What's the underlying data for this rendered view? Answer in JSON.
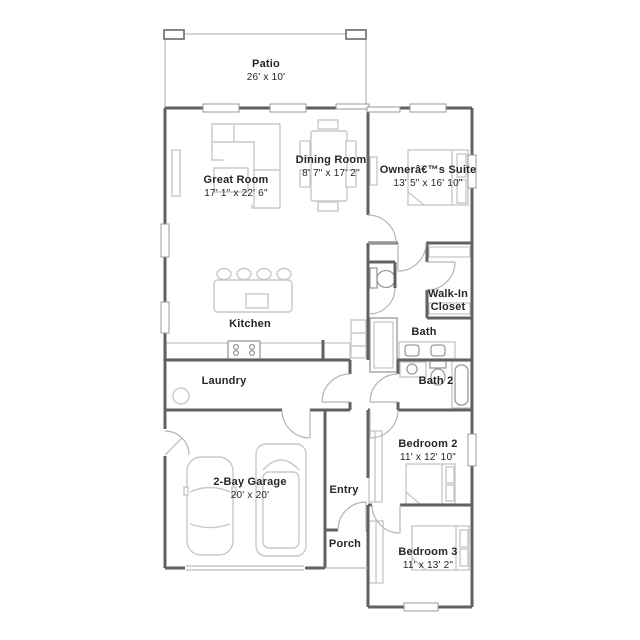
{
  "plan": {
    "colors": {
      "wall": "#616161",
      "light": "#c9c9c9",
      "door": "#b5b5b5",
      "text": "#262626"
    }
  },
  "rooms": [
    {
      "id": "patio",
      "name": "Patio",
      "dims": "26' x 10'",
      "cx": 266,
      "top": 58
    },
    {
      "id": "great-room",
      "name": "Great Room",
      "dims": "17' 1\" x 22' 6\"",
      "cx": 236,
      "top": 174
    },
    {
      "id": "dining-room",
      "name": "Dining Room",
      "dims": "8' 7\" x 17' 2\"",
      "cx": 331,
      "top": 154
    },
    {
      "id": "owners-suite",
      "name": "Ownerâ€™s Suite",
      "dims": "13' 5\" x 16' 10\"",
      "cx": 428,
      "top": 164
    },
    {
      "id": "kitchen",
      "name": "Kitchen",
      "dims": "",
      "cx": 250,
      "top": 318
    },
    {
      "id": "walk-in-closet",
      "name": "Walk-In Closet",
      "dims": "",
      "cx": 448,
      "top": 288
    },
    {
      "id": "bath",
      "name": "Bath",
      "dims": "",
      "cx": 424,
      "top": 326
    },
    {
      "id": "laundry",
      "name": "Laundry",
      "dims": "",
      "cx": 224,
      "top": 375
    },
    {
      "id": "bath-2",
      "name": "Bath 2",
      "dims": "",
      "cx": 436,
      "top": 375
    },
    {
      "id": "bedroom-2",
      "name": "Bedroom 2",
      "dims": "11' x 12' 10\"",
      "cx": 428,
      "top": 438
    },
    {
      "id": "garage",
      "name": "2-Bay Garage",
      "dims": "20' x 20'",
      "cx": 250,
      "top": 476
    },
    {
      "id": "entry",
      "name": "Entry",
      "dims": "",
      "cx": 344,
      "top": 484
    },
    {
      "id": "porch",
      "name": "Porch",
      "dims": "",
      "cx": 345,
      "top": 538
    },
    {
      "id": "bedroom-3",
      "name": "Bedroom 3",
      "dims": "11' x 13' 2\"",
      "cx": 428,
      "top": 546
    }
  ]
}
